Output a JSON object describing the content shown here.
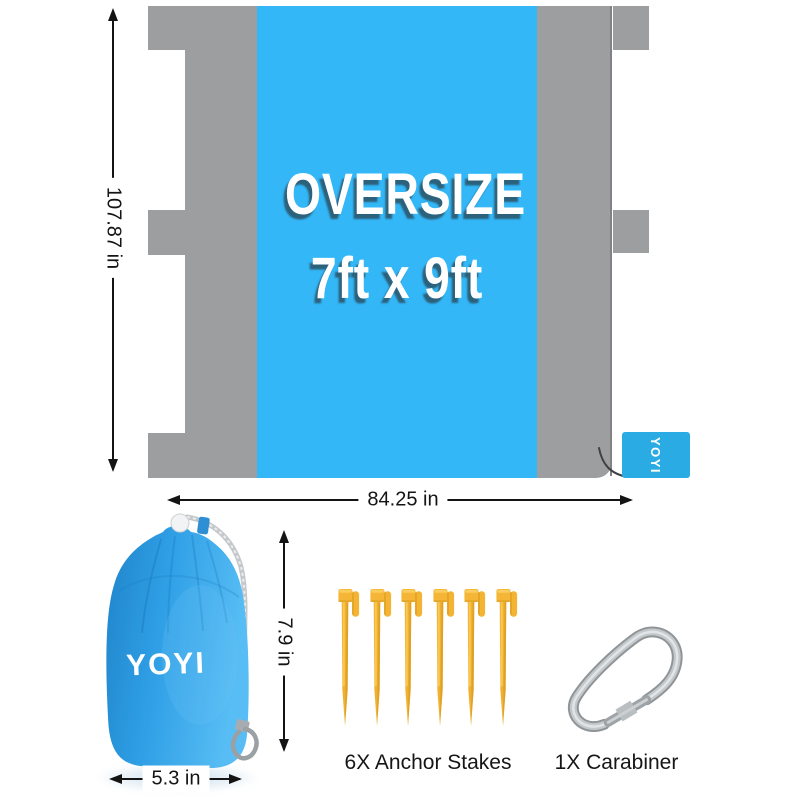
{
  "blanket": {
    "oversize_label": "OVERSIZE",
    "size_label": "7ft x 9ft",
    "brand_tag": "YOYI",
    "height_label": "107.87 in",
    "width_label": "84.25 in"
  },
  "bag": {
    "brand": "YOYI",
    "height_label": "7.9 in",
    "width_label": "5.3 in"
  },
  "accessories": {
    "stakes_label": "6X Anchor Stakes",
    "stakes_count": 6,
    "carabiner_label": "1X Carabiner",
    "carabiner_count": 1
  },
  "colors": {
    "blanket_gray": "#9d9ea0",
    "blanket_blue": "#33b7f7",
    "tag_blue": "#2aabe3",
    "bag_blue": "#2f9fe6",
    "stake_yellow": "#f2b232",
    "metal_gray": "#b9bdc0",
    "dimension_text": "#141414"
  }
}
